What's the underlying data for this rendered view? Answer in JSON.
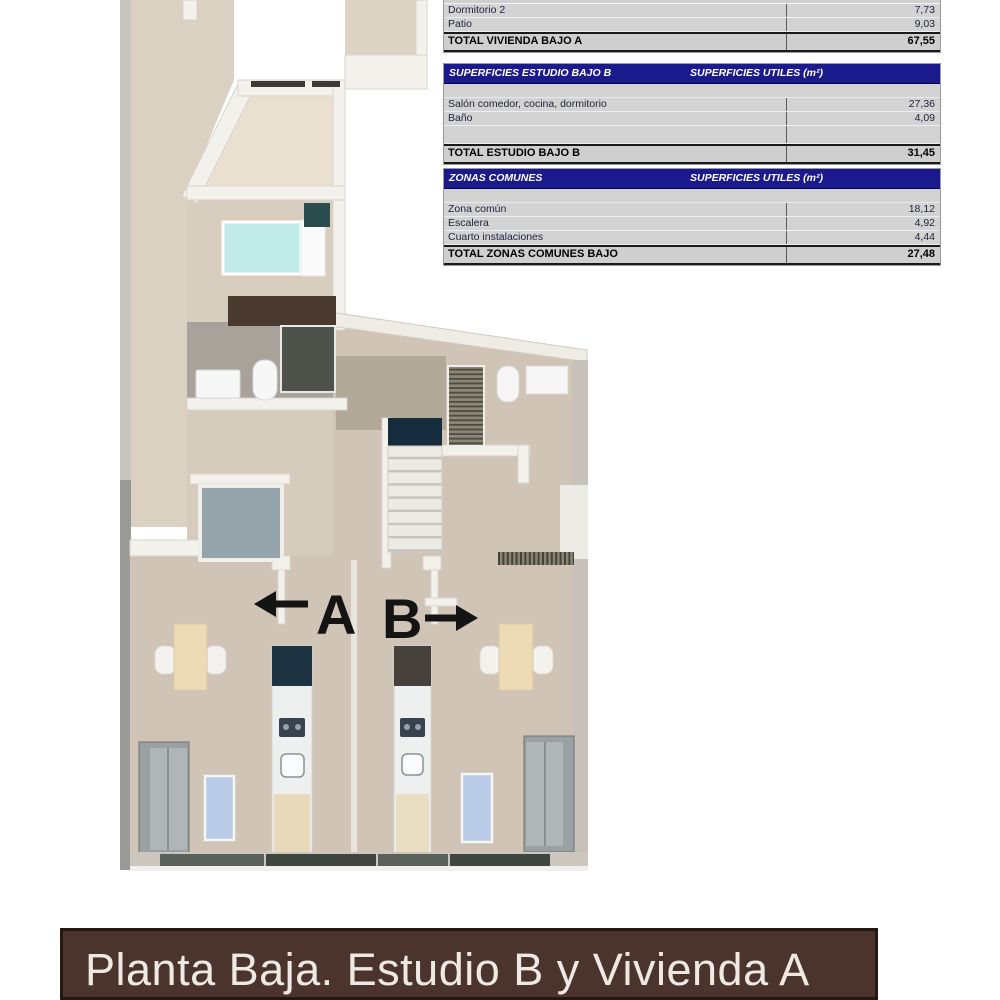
{
  "footer": {
    "title": "Planta Baja. Estudio B y Vivienda A"
  },
  "plan": {
    "unit_a_label": "A",
    "unit_b_label": "B"
  },
  "tables": {
    "units_header": "SUPERFICIES UTILES  (m²)",
    "vivienda_a": {
      "rows": [
        {
          "label": "Dormitorio 2",
          "value": "7,73"
        },
        {
          "label": "Patio",
          "value": "9,03"
        }
      ],
      "total_label": "TOTAL VIVIENDA BAJO A",
      "total_value": "67,55"
    },
    "estudio_b": {
      "title": "SUPERFICIES ESTUDIO BAJO B",
      "rows": [
        {
          "label": "Salón comedor, cocina, dormitorio",
          "value": "27,36"
        },
        {
          "label": "Baño",
          "value": "4,09"
        },
        {
          "label": "",
          "value": ""
        }
      ],
      "total_label": "TOTAL ESTUDIO BAJO B",
      "total_value": "31,45"
    },
    "zonas_comunes": {
      "title": "ZONAS COMUNES",
      "rows": [
        {
          "label": "Zona común",
          "value": "18,12"
        },
        {
          "label": "Escalera",
          "value": "4,92"
        },
        {
          "label": "Cuarto instalaciones",
          "value": "4,44"
        }
      ],
      "total_label": "TOTAL ZONAS COMUNES BAJO",
      "total_value": "27,48"
    }
  },
  "colors": {
    "table_header_bg": "#1a1a8c",
    "table_row_bg": "#d3d3d3",
    "footer_bg": "#4a342d",
    "floor_taupe": "#cfc4b6",
    "terrain_beige": "#dbd1c2",
    "bed_cyan": "#c0ebe7",
    "rug_blue": "#b9cbe7"
  }
}
